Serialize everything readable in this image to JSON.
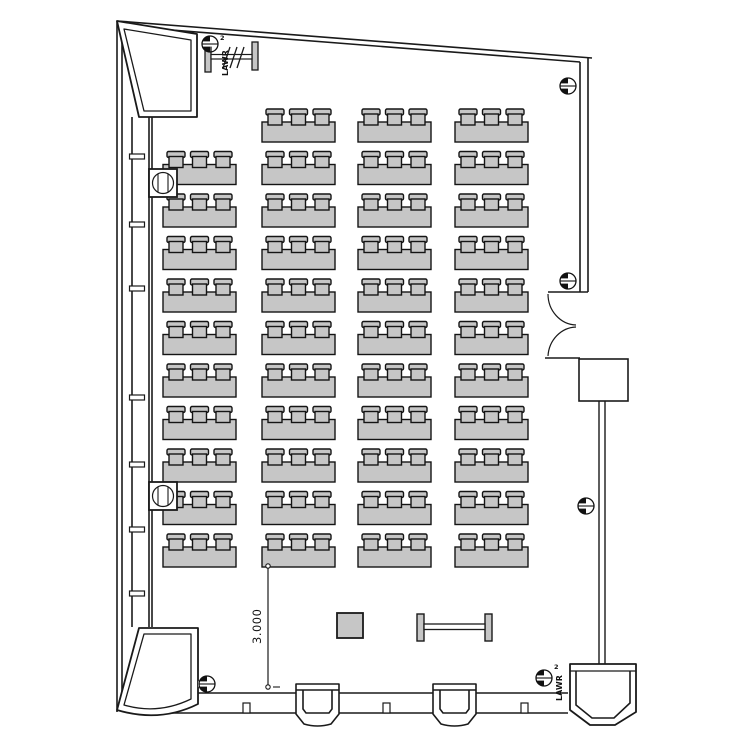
{
  "plan": {
    "kind": "lecture-room-floor-plan",
    "annotations": {
      "dimension_label": "3.000",
      "marker_label": "LAWR",
      "marker_number": "2"
    },
    "colors": {
      "furniture_fill": "#c6c6c6",
      "wall_line": "#1a1a1a",
      "background": "#ffffff"
    },
    "seating": {
      "table_width": 73,
      "table_height": 20,
      "chairs_per_table": 3,
      "row_first_y": 122,
      "row_pitch": 42.5,
      "row_count": 11,
      "columns": [
        {
          "x": 163,
          "start_row": 1
        },
        {
          "x": 262,
          "start_row": 0
        },
        {
          "x": 358,
          "start_row": 0
        },
        {
          "x": 455,
          "start_row": 0
        }
      ]
    }
  }
}
